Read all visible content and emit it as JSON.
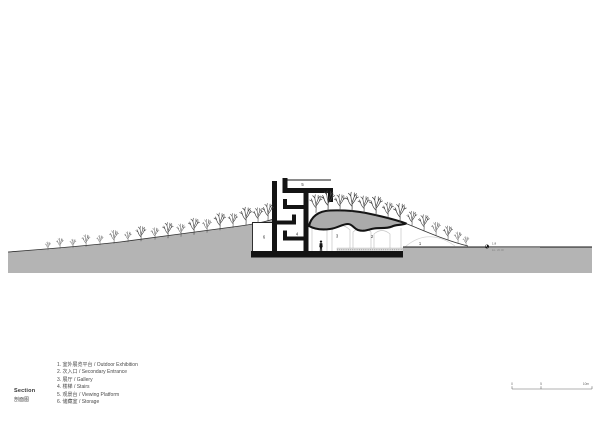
{
  "title": {
    "en": "Section",
    "zh": "剖面图"
  },
  "legend": {
    "items": [
      "1. 室外展览平台 / Outdoor Exhibition",
      "2. 次入口 / Secondary Entrance",
      "3. 展厅 / Gallery",
      "4. 楼梯 / Stairs",
      "5. 观景台 / Viewing Platform",
      "6. 储藏室 / Storage"
    ]
  },
  "drawing": {
    "labels": [
      "1",
      "2",
      "3",
      "4",
      "5",
      "6"
    ],
    "benchmark": {
      "value": "1.8",
      "elevation": "EL. 20.00"
    },
    "colors": {
      "earth": "#b4b4b4",
      "cut_mass": "#ababab",
      "structure": "#141414",
      "faint_line": "#c6c6c6"
    }
  },
  "scale_bar": {
    "labels": [
      "0",
      "5",
      "10m"
    ]
  }
}
